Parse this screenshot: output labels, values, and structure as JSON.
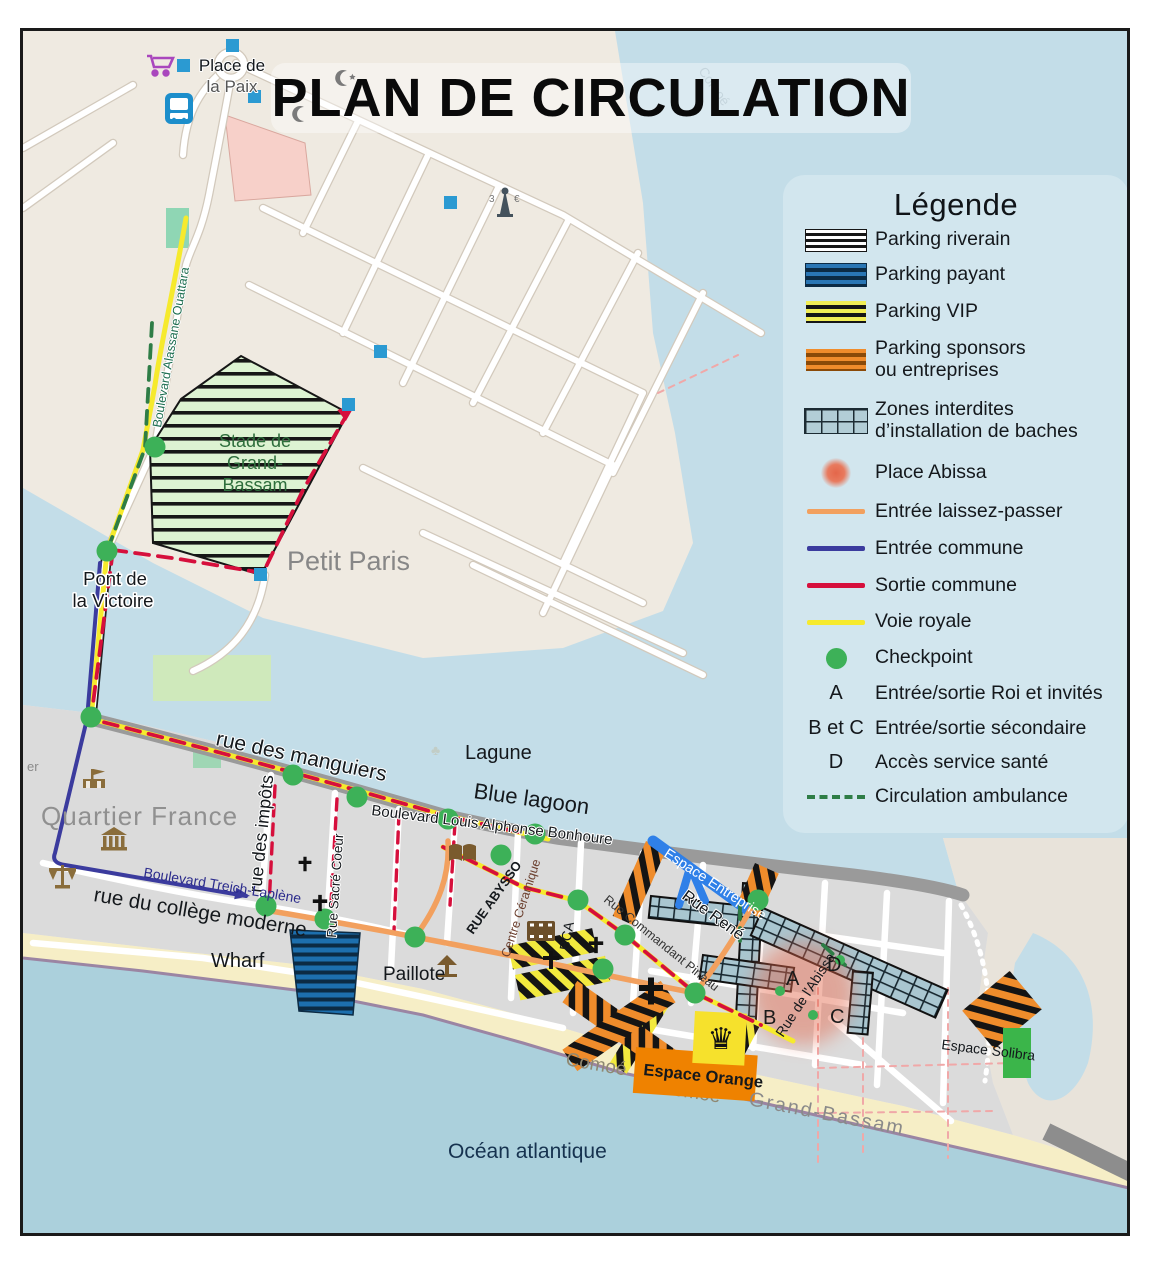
{
  "title": "PLAN DE CIRCULATION",
  "legend": {
    "title": "Légende",
    "items": [
      {
        "label": "Parking riverain"
      },
      {
        "label": "Parking payant"
      },
      {
        "label": "Parking VIP"
      },
      {
        "label": "Parking sponsors",
        "label2": "ou entreprises"
      },
      {
        "label": "Zones interdites",
        "label2": "d’installation de baches"
      },
      {
        "label": "Place Abissa"
      },
      {
        "label": "Entrée laissez-passer"
      },
      {
        "label": "Entrée commune"
      },
      {
        "label": "Sortie commune"
      },
      {
        "label": "Voie royale"
      },
      {
        "label": "Checkpoint"
      },
      {
        "key": "A",
        "label": "Entrée/sortie Roi et invités"
      },
      {
        "key": "B et C",
        "label": "Entrée/sortie sécondaire"
      },
      {
        "key": "D",
        "label": "Accès service santé"
      },
      {
        "label": "Circulation ambulance"
      }
    ]
  },
  "map": {
    "labels": {
      "place_paix_1": "Place de",
      "place_paix_2": "la Paix",
      "petit_paris": "Petit Paris",
      "pont_1": "Pont de",
      "pont_2": "la Victoire",
      "stade_1": "Stade de",
      "stade_2": "Grand-",
      "stade_3": "Bassam",
      "blvd_ouattara": "Boulevard Alassane Ouattara",
      "quartier_france": "Quartier France",
      "er": "er",
      "rue_manguiers": "rue des manguiers",
      "lagune": "Lagune",
      "blue_lagoon": "Blue lagoon",
      "rue_impots": "rue des impôts",
      "rue_sacre_coeur": "Rue Sacré Coeur",
      "blvd_bonhoure": "Boulevard Louis Alphonse Bonhoure",
      "blvd_treich": "Boulevard Treich-Laplène",
      "rue_college": "rue du collège moderne",
      "wharf": "Wharf",
      "paillote": "Paillote",
      "centre_ceramique": "Centre Céramique",
      "rue_abysso": "RUE ABYSSO",
      "bca": "BCA",
      "espace_entreprise": "Espace Entreprise",
      "rue_rene": "Rue René",
      "rue_pineau": "Rue Commandant Pineau",
      "rue_abissa": "Rue de l'Abissa",
      "espace_orange": "Espace Orange",
      "espace_solibra": "Espace Solibra",
      "comoe_beach": "Comoé",
      "du_comoe": "du Comoé",
      "grand_bassam": "Grand-Bassam",
      "ocean": "Océan atlantique",
      "comoe_river": "Comoé",
      "fee_left": "3",
      "fee_right": "€"
    },
    "letters": {
      "a": "A",
      "b": "B",
      "c": "C",
      "d": "D"
    }
  },
  "colors": {
    "voie_royale": "#f6ea2d",
    "sortie_commune": "#d60f3c",
    "entree_commune": "#3b3b9e",
    "laissez_passer": "#f2a05e",
    "checkpoint": "#3db158",
    "ambulance": "#2e7d46",
    "parking_payant": "#1d6fae",
    "parking_vip": "#f2ee55",
    "parking_sponsors": "#f08c2b",
    "zones_interdites": "#a9c6d0",
    "place_abissa": "#e4664a",
    "water": "#c3dde8",
    "espace_orange": "#ef8200",
    "espace_solibra": "#3bb54a",
    "espace_entreprise": "#2f80e8"
  }
}
